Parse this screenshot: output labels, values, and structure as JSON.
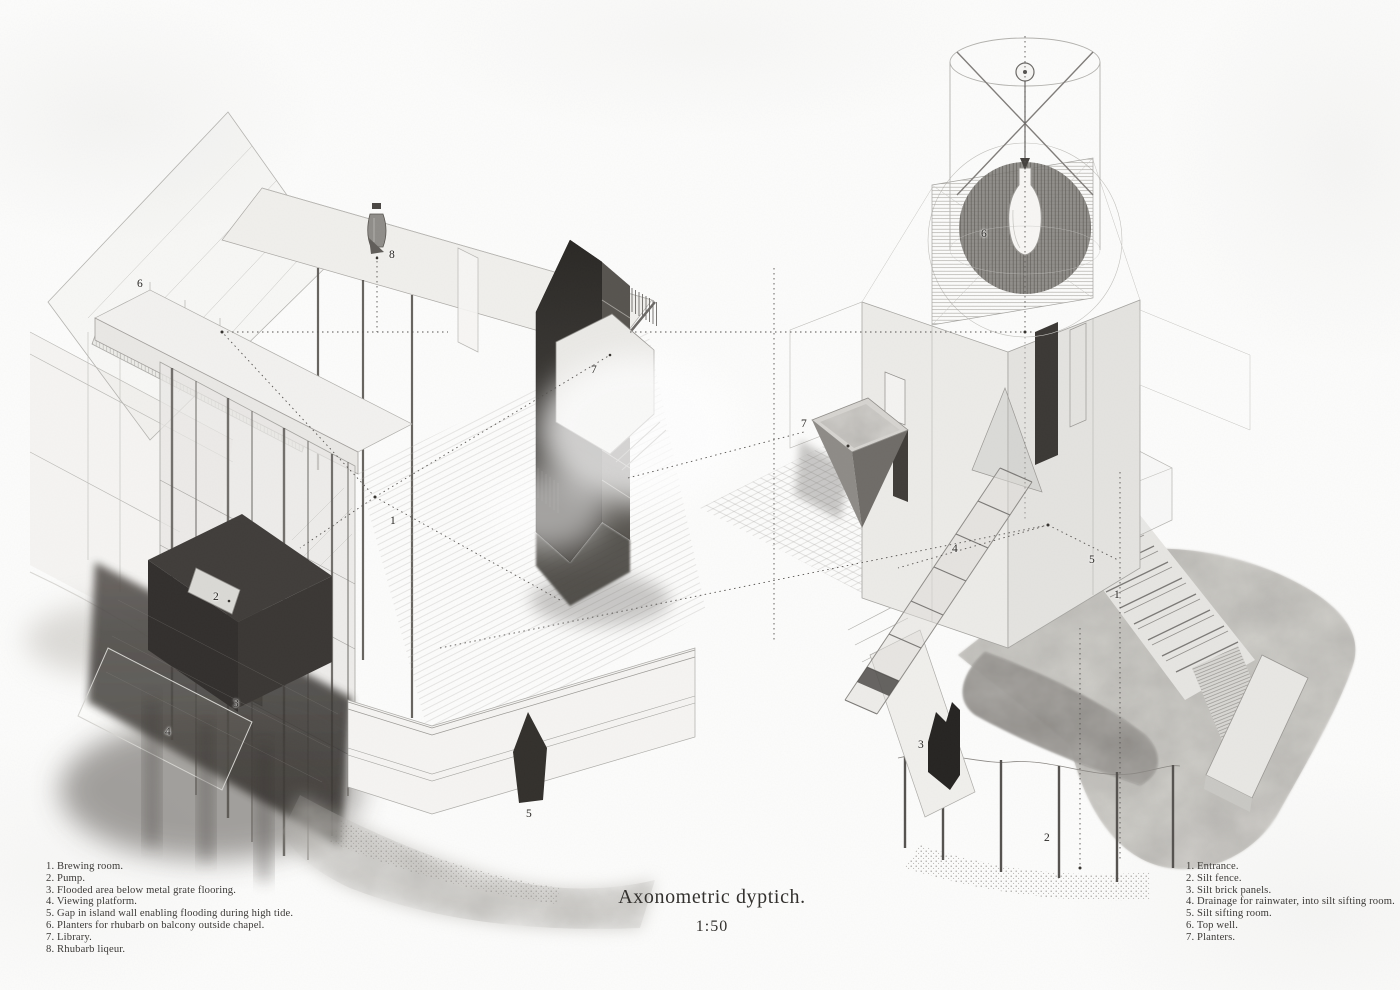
{
  "sheet": {
    "title": "Axonometric dyptich.",
    "scale": "1:50"
  },
  "left_drawing": {
    "name": "island-brewery-axonometric",
    "callouts": [
      {
        "label": "1",
        "x": 393,
        "y": 521
      },
      {
        "label": "2",
        "x": 216,
        "y": 597
      },
      {
        "label": "3",
        "x": 236,
        "y": 704
      },
      {
        "label": "4",
        "x": 168,
        "y": 732
      },
      {
        "label": "5",
        "x": 529,
        "y": 814
      },
      {
        "label": "6",
        "x": 140,
        "y": 284
      },
      {
        "label": "7",
        "x": 594,
        "y": 370
      },
      {
        "label": "8",
        "x": 392,
        "y": 255
      }
    ],
    "legend": [
      "1. Brewing room.",
      "2. Pump.",
      "3. Flooded area below metal grate flooring.",
      "4. Viewing platform.",
      "5. Gap in island wall enabling flooding during high tide.",
      "6. Planters for rhubarb on balcony outside chapel.",
      "7. Library.",
      "8. Rhubarb liqeur."
    ]
  },
  "right_drawing": {
    "name": "silt-tower-axonometric",
    "callouts": [
      {
        "label": "1",
        "x": 1117,
        "y": 595
      },
      {
        "label": "2",
        "x": 1047,
        "y": 838
      },
      {
        "label": "3",
        "x": 921,
        "y": 745
      },
      {
        "label": "4",
        "x": 955,
        "y": 549
      },
      {
        "label": "5",
        "x": 1092,
        "y": 560
      },
      {
        "label": "6",
        "x": 984,
        "y": 234
      },
      {
        "label": "7",
        "x": 804,
        "y": 424
      }
    ],
    "legend": [
      "1. Entrance.",
      "2. Silt fence.",
      "3. Silt brick panels.",
      "4. Drainage for rainwater, into silt sifting room.",
      "5. Silt sifting room.",
      "6. Top well.",
      "7. Planters."
    ]
  },
  "palette": {
    "paper": "#fcfcfb",
    "ink_light": "#b0afab",
    "ink_mid": "#8f8d89",
    "ink_dark": "#55524f",
    "mass_dark": "#2e2b28",
    "text": "#3b3936"
  }
}
